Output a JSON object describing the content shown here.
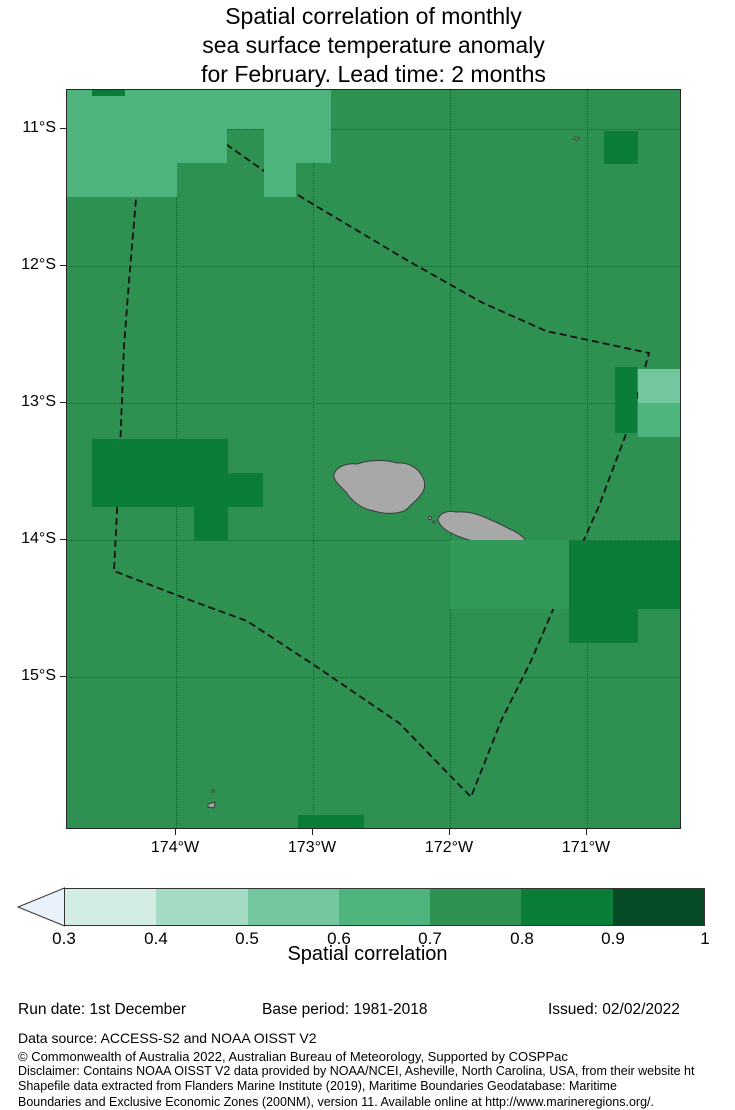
{
  "title": {
    "lines": [
      "Spatial correlation of monthly",
      "sea surface temperature anomaly",
      "for February. Lead time: 2 months"
    ]
  },
  "chart_data": {
    "type": "heatmap",
    "title": "Spatial correlation of monthly sea surface temperature anomaly for February. Lead time: 2 months",
    "x_tick_labels": [
      "174°W",
      "173°W",
      "172°W",
      "171°W"
    ],
    "y_tick_labels": [
      "11°S",
      "12°S",
      "13°S",
      "14°S",
      "15°S"
    ],
    "colorbar_label": "Spatial correlation",
    "colorbar_ticks": [
      0.3,
      0.4,
      0.5,
      0.6,
      0.7,
      0.8,
      0.9,
      1
    ],
    "base_band": "0.7-0.8",
    "notes": "Correlation map around Samoa; dashed polygon is EEZ boundary; gray shapes are islands (Savai'i, Upolu, Tutuila)."
  },
  "map": {
    "geometry": {
      "left": 66,
      "top": 89,
      "width": 615,
      "height": 740
    },
    "band_colors": {
      "0.3-0.4": "#d4ede4",
      "0.4-0.5": "#a5dbc4",
      "0.5-0.6": "#72c79e",
      "0.6-0.7": "#4cb47c",
      "0.7-0.8": "#2e9152",
      "0.7-0.8b": "#33995b",
      "0.8-0.9": "#0a7d39",
      "0.9-1.0": "#064a26"
    },
    "cells": [
      {
        "band": "0.6-0.7",
        "x": 66,
        "y": 89,
        "w": 160,
        "h": 73
      },
      {
        "band": "0.6-0.7",
        "x": 66,
        "y": 162,
        "w": 110,
        "h": 34
      },
      {
        "band": "0.6-0.7",
        "x": 226,
        "y": 89,
        "w": 104,
        "h": 39
      },
      {
        "band": "0.6-0.7",
        "x": 263,
        "y": 128,
        "w": 32,
        "h": 68
      },
      {
        "band": "0.6-0.7",
        "x": 295,
        "y": 128,
        "w": 35,
        "h": 34
      },
      {
        "band": "0.5-0.6",
        "x": 637,
        "y": 368,
        "w": 44,
        "h": 34
      },
      {
        "band": "0.6-0.7",
        "x": 637,
        "y": 402,
        "w": 44,
        "h": 34
      },
      {
        "band": "0.7-0.8b",
        "x": 449,
        "y": 539,
        "w": 119,
        "h": 69
      },
      {
        "band": "0.8-0.9",
        "x": 91,
        "y": 89,
        "w": 33,
        "h": 6
      },
      {
        "band": "0.8-0.9",
        "x": 603,
        "y": 130,
        "w": 34,
        "h": 33
      },
      {
        "band": "0.8-0.9",
        "x": 91,
        "y": 438,
        "w": 136,
        "h": 68
      },
      {
        "band": "0.8-0.9",
        "x": 227,
        "y": 472,
        "w": 35,
        "h": 34
      },
      {
        "band": "0.8-0.9",
        "x": 193,
        "y": 506,
        "w": 34,
        "h": 34
      },
      {
        "band": "0.8-0.9",
        "x": 614,
        "y": 366,
        "w": 22,
        "h": 66
      },
      {
        "band": "0.8-0.9",
        "x": 568,
        "y": 540,
        "w": 113,
        "h": 68
      },
      {
        "band": "0.8-0.9",
        "x": 568,
        "y": 608,
        "w": 69,
        "h": 34
      },
      {
        "band": "0.8-0.9",
        "x": 297,
        "y": 814,
        "w": 66,
        "h": 15
      }
    ],
    "x_ticks": [
      {
        "label": "174°W",
        "x": 175
      },
      {
        "label": "173°W",
        "x": 312
      },
      {
        "label": "172°W",
        "x": 449
      },
      {
        "label": "171°W",
        "x": 586
      }
    ],
    "y_ticks": [
      {
        "label": "11°S",
        "y": 128
      },
      {
        "label": "12°S",
        "y": 265
      },
      {
        "label": "13°S",
        "y": 402
      },
      {
        "label": "14°S",
        "y": 539
      },
      {
        "label": "15°S",
        "y": 676
      }
    ]
  },
  "colorbar": {
    "label": "Spatial correlation",
    "arrow_color": "#e9f2fa",
    "segments": [
      "0.3-0.4",
      "0.4-0.5",
      "0.5-0.6",
      "0.6-0.7",
      "0.7-0.8",
      "0.8-0.9",
      "0.9-1.0"
    ],
    "ticks": [
      {
        "label": "0.3",
        "x": 64
      },
      {
        "label": "0.4",
        "x": 156
      },
      {
        "label": "0.5",
        "x": 247
      },
      {
        "label": "0.6",
        "x": 339
      },
      {
        "label": "0.7",
        "x": 430
      },
      {
        "label": "0.8",
        "x": 522
      },
      {
        "label": "0.9",
        "x": 613
      },
      {
        "label": "1",
        "x": 705
      }
    ]
  },
  "footer": {
    "run_date": "Run date: 1st December",
    "base_period": "Base period: 1981-2018",
    "issued": "Issued: 02/02/2022",
    "data_source": "Data source: ACCESS-S2 and NOAA OISST V2",
    "copyright": "© Commonwealth of Australia 2022, Australian Bureau of Meteorology, Supported by COSPPac",
    "disclaimer_lines": [
      "Disclaimer: Contains NOAA OISST V2 data provided by NOAA/NCEI, Asheville, North Carolina, USA, from their website ht",
      "Shapefile data extracted from Flanders Marine Institute (2019), Maritime Boundaries Geodatabase: Maritime",
      "Boundaries and Exclusive Economic Zones (200NM), version 11. Available online at http://www.marineregions.org/."
    ]
  }
}
